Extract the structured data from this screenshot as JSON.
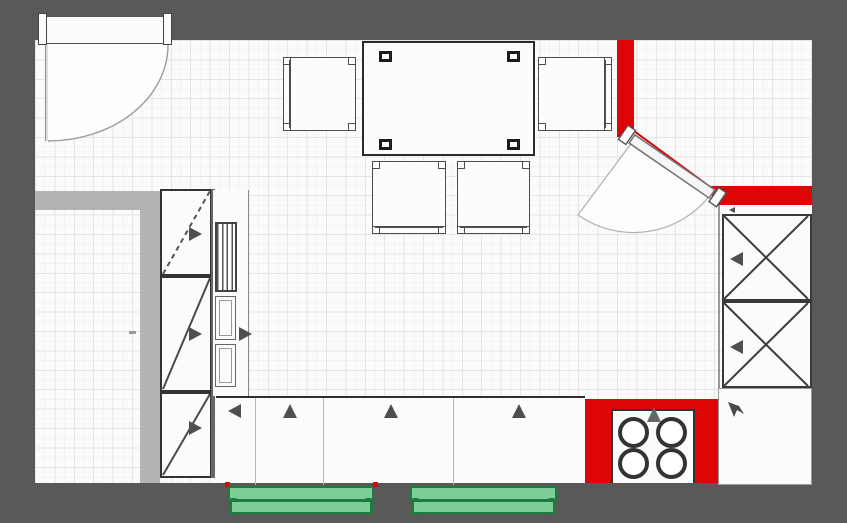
{
  "plan": {
    "kind": "kitchen-floor-plan",
    "inventory": {
      "doors": 2,
      "dining_table": 1,
      "dining_chairs": 4,
      "table_legs": 4,
      "tall_cabinets_left": 3,
      "x_front_cabinets_right": 2,
      "base_cabinet_sections": 3,
      "stove_burners": 4,
      "benches": 2,
      "vent_unit": 1,
      "drawer_boxes": 2
    }
  },
  "colors": {
    "canvas": "#595959",
    "floor": "#fbfbfb",
    "grid_minor": "#f3f3f3",
    "grid_major": "#e5e5e5",
    "wall": "#b4b4b4",
    "red": "#dd0505",
    "green": "#7ccd96",
    "green_dark": "#1e7a3e",
    "line": "#333333",
    "line_soft": "#999999",
    "marker": "#4f4f4f"
  }
}
